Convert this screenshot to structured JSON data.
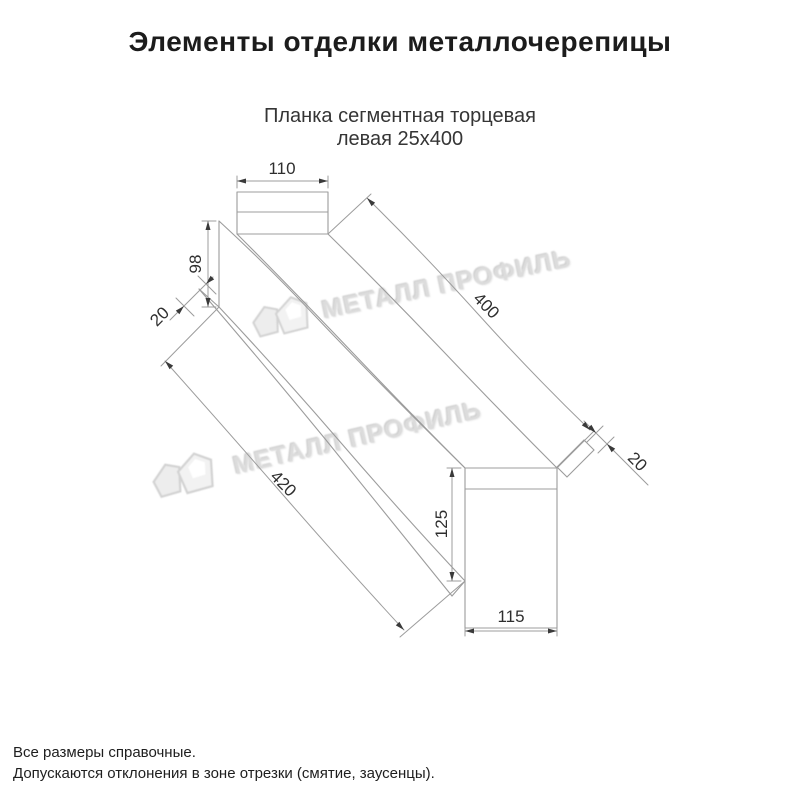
{
  "header": {
    "title": "Элементы отделки металлочерепицы"
  },
  "product": {
    "subtitle_line1": "Планка сегментная торцевая",
    "subtitle_line2": "левая 25х400"
  },
  "drawing": {
    "type": "technical-dimension-drawing",
    "dims": {
      "top_width": "110",
      "left_height": "98",
      "near_flange": "20",
      "length_top": "400",
      "length_bottom": "420",
      "far_flange": "20",
      "end_height": "125",
      "end_width": "115"
    }
  },
  "watermark": {
    "text": "МЕТАЛЛ ПРОФИЛЬ"
  },
  "footer": {
    "line1": "Все размеры справочные.",
    "line2": "Допускаются отклонения в зоне отрезки (смятие, заусенцы)."
  },
  "colors": {
    "line": "#9c9c9c",
    "arrow": "#3a3a3a",
    "text": "#2e2e2e",
    "watermark": "#dcdcdc"
  }
}
